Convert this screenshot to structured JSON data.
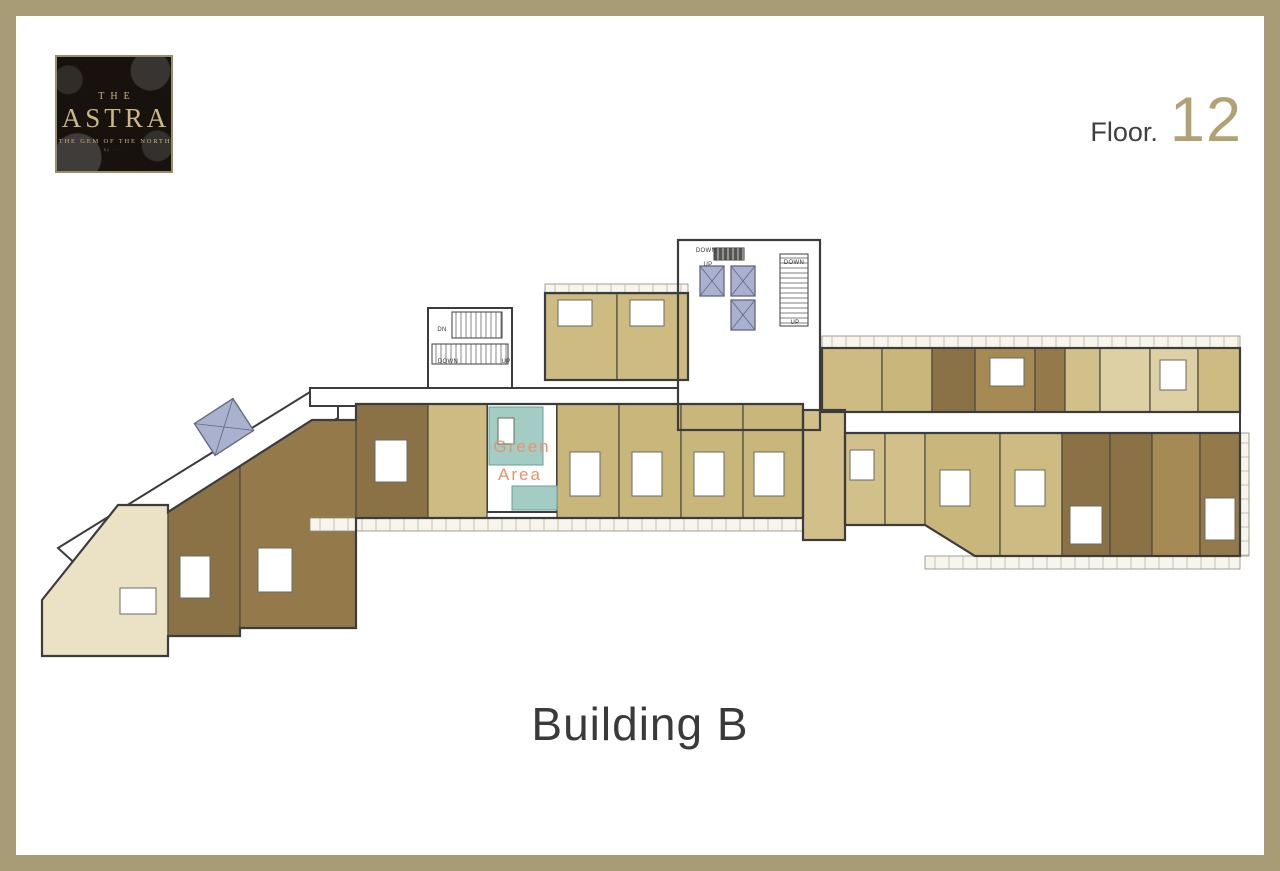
{
  "frame": {
    "color": "#a89c77"
  },
  "logo": {
    "line1": "THE",
    "line2": "ASTRA",
    "line3": "THE GEM OF THE NORTH",
    "line4": "by ·····"
  },
  "floor": {
    "prefix": "Floor.",
    "number": "12"
  },
  "building": {
    "label": "Building B"
  },
  "plan": {
    "wall": "#3c3c3c",
    "unit_stroke": "#4a463c",
    "white_blocks": [
      {
        "points": "58,548 310,392 338,392 338,418 80,568"
      },
      {
        "rect": [
          310,
          388,
          535,
          18
        ]
      },
      {
        "rect": [
          678,
          240,
          142,
          190
        ]
      },
      {
        "rect": [
          428,
          308,
          84,
          80
        ]
      },
      {
        "rect": [
          845,
          412,
          395,
          21
        ]
      },
      {
        "rect": [
          487,
          404,
          70,
          108
        ]
      }
    ],
    "units": [
      {
        "name": "unit",
        "points": "42,600 118,505 168,505 168,656 42,656",
        "fill": "#ebe2c5"
      },
      {
        "name": "unit",
        "points": "168,512 240,466 240,636 168,636",
        "fill": "#8a7246"
      },
      {
        "name": "unit",
        "points": "240,466 312,420 356,420 356,628 240,628",
        "fill": "#94794b"
      },
      {
        "name": "unit",
        "rect": [
          356,
          404,
          72,
          114
        ],
        "fill": "#8a7246"
      },
      {
        "name": "unit",
        "rect": [
          428,
          404,
          59,
          114
        ],
        "fill": "#cdbb82"
      },
      {
        "name": "unit",
        "rect": [
          557,
          404,
          62,
          114
        ],
        "fill": "#c8b67b"
      },
      {
        "name": "unit",
        "rect": [
          619,
          404,
          62,
          114
        ],
        "fill": "#c8b67b"
      },
      {
        "name": "unit",
        "rect": [
          681,
          404,
          62,
          114
        ],
        "fill": "#c8b67b"
      },
      {
        "name": "unit",
        "rect": [
          743,
          404,
          60,
          114
        ],
        "fill": "#c8b67b"
      },
      {
        "name": "unit",
        "rect": [
          803,
          410,
          42,
          130
        ],
        "fill": "#d2c08a"
      },
      {
        "name": "unit",
        "rect": [
          545,
          293,
          72,
          87
        ],
        "fill": "#cdbb82"
      },
      {
        "name": "unit",
        "rect": [
          617,
          293,
          71,
          87
        ],
        "fill": "#cdbb82"
      },
      {
        "name": "unit",
        "rect": [
          822,
          348,
          60,
          64
        ],
        "fill": "#cdbb82"
      },
      {
        "name": "unit",
        "rect": [
          882,
          348,
          50,
          64
        ],
        "fill": "#c8b67b"
      },
      {
        "name": "unit",
        "rect": [
          932,
          348,
          43,
          64
        ],
        "fill": "#8a7246"
      },
      {
        "name": "unit",
        "rect": [
          975,
          348,
          60,
          64
        ],
        "fill": "#a58a54"
      },
      {
        "name": "unit",
        "rect": [
          1035,
          348,
          30,
          64
        ],
        "fill": "#94794b"
      },
      {
        "name": "unit",
        "rect": [
          1065,
          348,
          35,
          64
        ],
        "fill": "#d2c08a"
      },
      {
        "name": "unit",
        "rect": [
          1100,
          348,
          50,
          64
        ],
        "fill": "#ddd0a5"
      },
      {
        "name": "unit",
        "rect": [
          1150,
          348,
          48,
          64
        ],
        "fill": "#ddd0a5"
      },
      {
        "name": "unit",
        "rect": [
          1198,
          348,
          42,
          64
        ],
        "fill": "#cdbb82"
      },
      {
        "name": "unit",
        "rect": [
          845,
          433,
          40,
          92
        ],
        "fill": "#d2c08a"
      },
      {
        "name": "unit",
        "rect": [
          885,
          433,
          40,
          92
        ],
        "fill": "#d2c08a"
      },
      {
        "name": "unit",
        "points": "925,433 1000,433 1000,556 975,556 925,525",
        "fill": "#c8b67b"
      },
      {
        "name": "unit",
        "rect": [
          1000,
          433,
          62,
          123
        ],
        "fill": "#cdbb82"
      },
      {
        "name": "unit",
        "rect": [
          1062,
          433,
          48,
          123
        ],
        "fill": "#8a7246"
      },
      {
        "name": "unit",
        "rect": [
          1110,
          433,
          42,
          123
        ],
        "fill": "#8a7246"
      },
      {
        "name": "unit",
        "rect": [
          1152,
          433,
          48,
          123
        ],
        "fill": "#a58a54"
      },
      {
        "name": "unit",
        "rect": [
          1200,
          433,
          40,
          123
        ],
        "fill": "#94794b"
      }
    ],
    "teal": {
      "color": "#a3cdc4",
      "stroke": "#6aa098",
      "rects": [
        [
          489,
          407,
          54,
          58
        ],
        [
          512,
          486,
          45,
          24
        ]
      ]
    },
    "balconies": [
      [
        545,
        284,
        143,
        10
      ],
      [
        310,
        518,
        493,
        13
      ],
      [
        822,
        336,
        418,
        12
      ],
      [
        925,
        556,
        315,
        13
      ],
      [
        1240,
        433,
        9,
        123
      ]
    ],
    "details": [
      [
        570,
        452,
        30,
        44
      ],
      [
        632,
        452,
        30,
        44
      ],
      [
        694,
        452,
        30,
        44
      ],
      [
        754,
        452,
        30,
        44
      ],
      [
        558,
        300,
        34,
        26
      ],
      [
        630,
        300,
        34,
        26
      ],
      [
        375,
        440,
        32,
        42
      ],
      [
        180,
        556,
        30,
        42
      ],
      [
        258,
        548,
        34,
        44
      ],
      [
        120,
        588,
        36,
        26
      ],
      [
        990,
        358,
        34,
        28
      ],
      [
        1070,
        506,
        32,
        38
      ],
      [
        1205,
        498,
        30,
        42
      ],
      [
        850,
        450,
        24,
        30
      ],
      [
        1160,
        360,
        26,
        30
      ],
      [
        940,
        470,
        30,
        36
      ],
      [
        1015,
        470,
        30,
        36
      ],
      [
        498,
        418,
        16,
        26
      ]
    ],
    "elevators": {
      "fill": "#a9b1cf",
      "stroke": "#5f6783",
      "shafts": [
        [
          700,
          266,
          24,
          30
        ],
        [
          731,
          266,
          24,
          30
        ],
        [
          731,
          300,
          24,
          30
        ]
      ],
      "diag": {
        "cx": 224,
        "cy": 427,
        "w": 46,
        "h": 38,
        "rot": -33
      }
    },
    "stairs": [
      {
        "x": 452,
        "y": 312,
        "w": 50,
        "h": 26,
        "dir": "v",
        "dark": false
      },
      {
        "x": 432,
        "y": 344,
        "w": 76,
        "h": 20,
        "dir": "v",
        "dark": false
      },
      {
        "x": 714,
        "y": 248,
        "w": 30,
        "h": 12,
        "dir": "v",
        "dark": true
      },
      {
        "x": 780,
        "y": 254,
        "w": 28,
        "h": 72,
        "dir": "h",
        "dark": false
      }
    ],
    "labels": [
      {
        "t": "DN",
        "x": 442,
        "y": 331,
        "s": 6,
        "c": "#333333"
      },
      {
        "t": "DOWN",
        "x": 448,
        "y": 363,
        "s": 6,
        "c": "#333333"
      },
      {
        "t": "UP",
        "x": 506,
        "y": 363,
        "s": 6,
        "c": "#333333"
      },
      {
        "t": "DOWN",
        "x": 706,
        "y": 252,
        "s": 6,
        "c": "#333333"
      },
      {
        "t": "UP",
        "x": 708,
        "y": 266,
        "s": 6,
        "c": "#333333"
      },
      {
        "t": "DOWN",
        "x": 794,
        "y": 264,
        "s": 6,
        "c": "#333333"
      },
      {
        "t": "UP",
        "x": 795,
        "y": 324,
        "s": 6,
        "c": "#333333"
      },
      {
        "t": "Green",
        "x": 522,
        "y": 452,
        "s": 17,
        "c": "#e8936c"
      },
      {
        "t": "Area",
        "x": 520,
        "y": 480,
        "s": 17,
        "c": "#e8936c"
      }
    ],
    "outlines": [
      {
        "points": "42,600 118,505 168,505 168,512 240,466 312,420 356,420 356,404 803,404 803,518 356,518 356,628 240,628 240,636 168,636 168,656 42,656"
      },
      {
        "rect": [
          545,
          293,
          143,
          87
        ]
      },
      {
        "rect": [
          678,
          240,
          142,
          190
        ]
      },
      {
        "rect": [
          822,
          348,
          418,
          64
        ]
      },
      {
        "points": "845,433 1240,433 1240,556 975,556 925,525 845,525"
      },
      {
        "rect": [
          803,
          410,
          42,
          130
        ]
      }
    ]
  }
}
